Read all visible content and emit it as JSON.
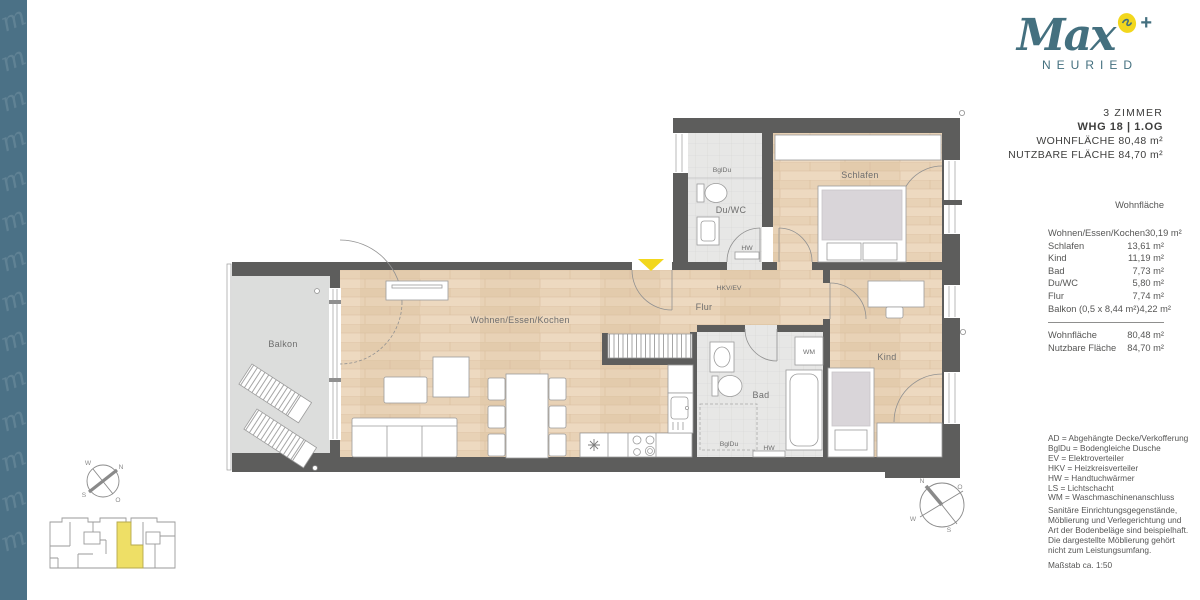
{
  "brand": {
    "name": "Max",
    "subtitle": "NEURIED",
    "plus": "+",
    "pattern_glyph": "m"
  },
  "title_block": {
    "rooms": "3 ZIMMER",
    "unit": "WHG 18 | 1.OG",
    "living_area": "WOHNFLÄCHE 80,48 m²",
    "usable_area": "NUTZBARE FLÄCHE 84,70 m²"
  },
  "area_table": {
    "header": "Wohnfläche",
    "rows": [
      {
        "label": "Wohnen/Essen/Kochen",
        "value": "30,19 m²"
      },
      {
        "label": "Schlafen",
        "value": "13,61 m²"
      },
      {
        "label": "Kind",
        "value": "11,19 m²"
      },
      {
        "label": "Bad",
        "value": "7,73 m²"
      },
      {
        "label": "Du/WC",
        "value": "5,80 m²"
      },
      {
        "label": "Flur",
        "value": "7,74 m²"
      },
      {
        "label": "Balkon (0,5 x 8,44 m²)",
        "value": "4,22 m²"
      }
    ],
    "totals": [
      {
        "label": "Wohnfläche",
        "value": "80,48 m²"
      },
      {
        "label": "Nutzbare Fläche",
        "value": "84,70 m²"
      }
    ]
  },
  "legend": {
    "lines": [
      "AD = Abgehängte Decke/Verkofferung",
      "BglDu = Bodengleiche Dusche",
      "EV = Elektroverteiler",
      "HKV = Heizkreisverteiler",
      "HW = Handtuchwärmer",
      "LS = Lichtschacht",
      "WM = Waschmaschinenanschluss"
    ]
  },
  "disclaimer": {
    "lines": [
      "Sanitäre Einrichtungsgegenstände,",
      "Möblierung und Verlegerichtung und",
      "Art der Bodenbeläge sind beispielhaft.",
      "Die dargestellte Möblierung gehört",
      "nicht zum Leistungsumfang."
    ]
  },
  "scale_note": "Maßstab ca. 1:50",
  "plan": {
    "rooms": {
      "balkon": "Balkon",
      "wohnen": "Wohnen/Essen/Kochen",
      "flur": "Flur",
      "schlafen": "Schlafen",
      "kind": "Kind",
      "bad": "Bad",
      "duwc": "Du/WC"
    },
    "annotations": {
      "bgldu_duwc": "BglDu",
      "hw_duwc": "HW",
      "hkv_ev": "HKV/EV",
      "wm": "WM",
      "bgldu_bad": "BglDu",
      "hw_bad": "HW"
    }
  },
  "compass": {
    "n": "N",
    "e": "O",
    "s": "S",
    "w": "W"
  },
  "colors": {
    "teal": "#4b7186",
    "logo_teal": "#44707f",
    "yellow": "#f2d71d",
    "wall": "#5d5d5c",
    "wood": "#e8d2b6",
    "tile": "#e7e7e6",
    "balcony": "#dcdddc",
    "text_dark": "#3e3e3d",
    "text_gray": "#565655"
  }
}
